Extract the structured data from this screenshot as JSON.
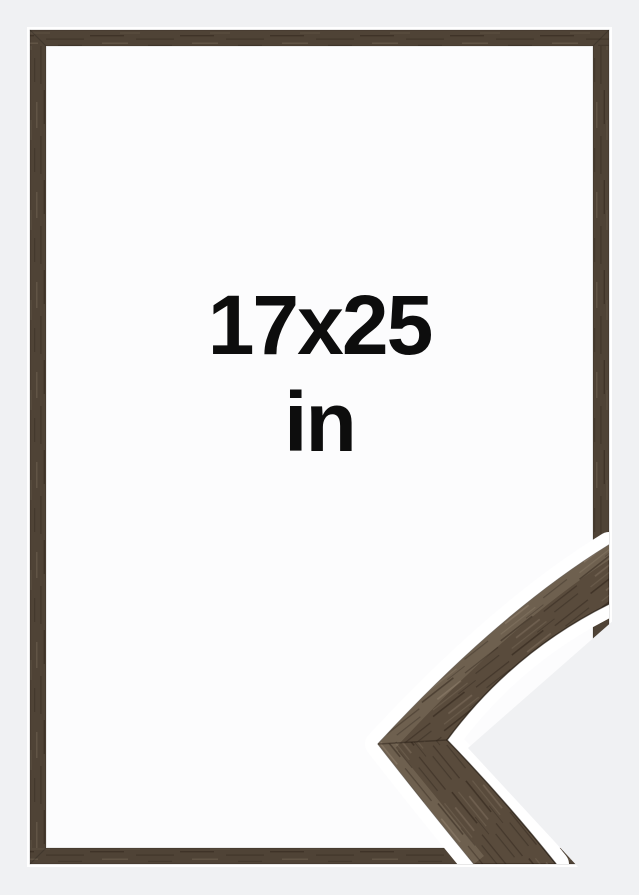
{
  "size_label": {
    "value": "17x25",
    "unit": "in"
  },
  "colors": {
    "page_background": "#f0f1f3",
    "frame_wood": "#4f4336",
    "sample_wood": "#594b3c",
    "wood_highlight": "#6e604f",
    "frame_opening": "#fcfcfd",
    "cutout_halo": "#ffffff",
    "label_text": "#0d0d0d"
  }
}
